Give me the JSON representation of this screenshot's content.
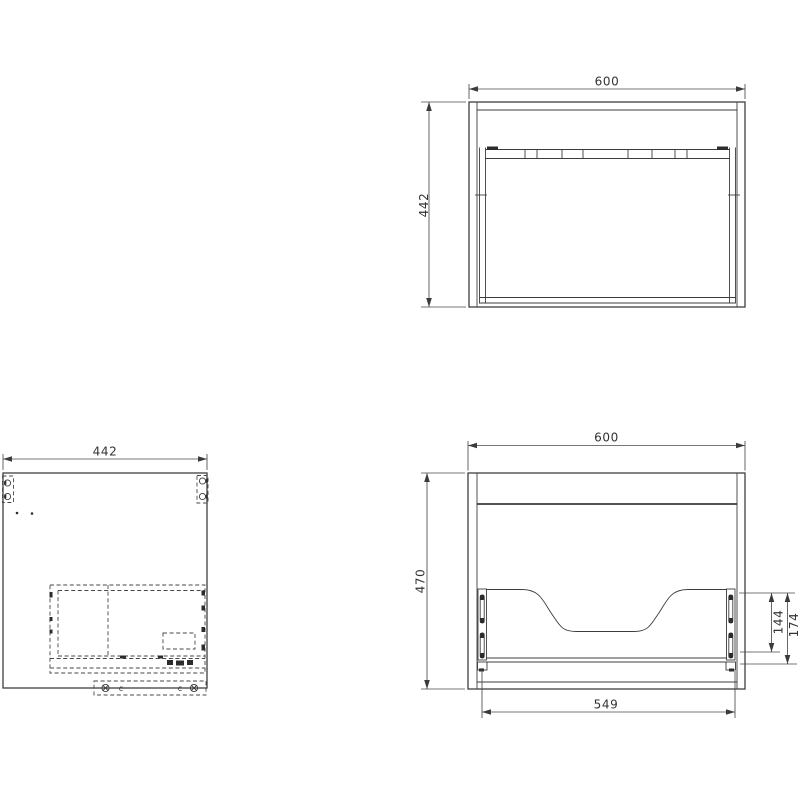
{
  "drawing": {
    "type": "cad-orthographic-views",
    "colors": {
      "line": "#383838",
      "dimension": "#4a4a4a",
      "background": "#ffffff"
    },
    "views": {
      "top": {
        "dim_width": "600",
        "dim_depth": "442"
      },
      "side": {
        "dim_depth": "442",
        "clip_left": "c",
        "clip_right": "c"
      },
      "front": {
        "dim_width": "600",
        "dim_height": "470",
        "dim_slide": "144",
        "dim_back": "174",
        "dim_drawer": "549"
      }
    }
  }
}
